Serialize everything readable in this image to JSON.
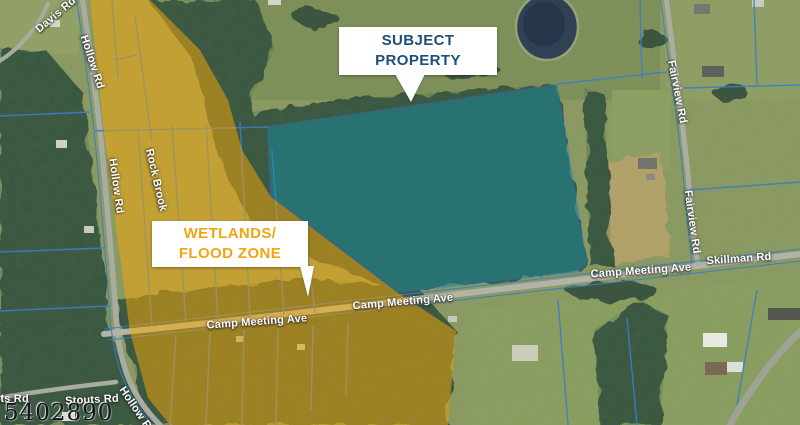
{
  "callouts": {
    "subject": {
      "line1": "SUBJECT",
      "line2": "PROPERTY"
    },
    "wetlands": {
      "line1": "WETLANDS/",
      "line2": "FLOOD ZONE"
    }
  },
  "map_labels": [
    {
      "text": "Davis Rd"
    },
    {
      "text": "Hollow Rd"
    },
    {
      "text": "Hollow Rd"
    },
    {
      "text": "Rock Brook"
    },
    {
      "text": "Camp Meeting Ave"
    },
    {
      "text": "Camp Meeting Ave"
    },
    {
      "text": "Camp Meeting Ave"
    },
    {
      "text": "Skillman Rd"
    },
    {
      "text": "Fairview Rd"
    },
    {
      "text": "Fairview Rd"
    },
    {
      "text": "Stouts Rd"
    },
    {
      "text": "Stouts Rd"
    },
    {
      "text": "Hollow Rd"
    }
  ],
  "watermark": "5402890",
  "colors": {
    "subject_text": "#1E4E79",
    "wetlands_text": "#F0A512",
    "subject_overlay": "#0D96B4",
    "wetlands_overlay": "#F5A70A",
    "parcel_line": "#3B7EC6"
  }
}
